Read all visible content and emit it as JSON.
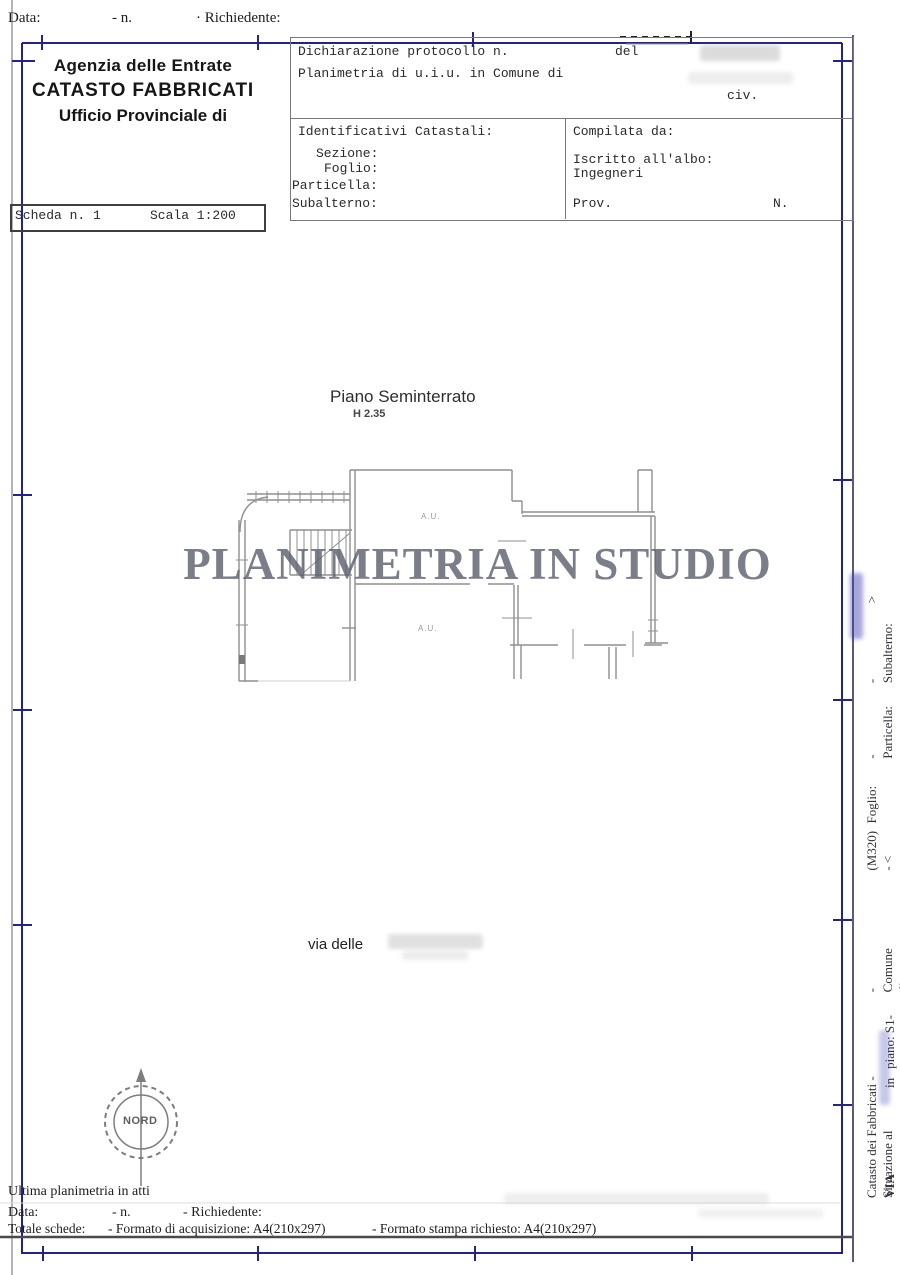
{
  "top_row": {
    "data_label": "Data:",
    "n_label": "- n.",
    "richiedente_label": "· Richiedente:"
  },
  "agency": {
    "line1": "Agenzia delle Entrate",
    "line2": "CATASTO FABBRICATI",
    "line3": "Ufficio Provinciale di"
  },
  "scheda": {
    "scheda_label": "Scheda n. 1",
    "scala_label": "Scala 1:200"
  },
  "protocol": {
    "dichiarazione_label": "Dichiarazione protocollo n.",
    "del_label": "del",
    "planimetria_label": "Planimetria di u.i.u. in Comune di",
    "civ_label": "civ."
  },
  "identificativi": {
    "title": "Identificativi Catastali:",
    "sezione_label": "Sezione:",
    "foglio_label": "Foglio:",
    "particella_label": "Particella:",
    "subalterno_label": "Subalterno:"
  },
  "compilata": {
    "title": "Compilata da:",
    "iscritto_label": "Iscritto all'albo:",
    "albo_value": "Ingegneri",
    "prov_label": "Prov.",
    "n_label": "N."
  },
  "drawing": {
    "floor_title": "Piano Seminterrato",
    "height_label": "H 2.35",
    "room_label_top": "A.U.",
    "room_label_bottom": "A.U.",
    "street_label": "via delle",
    "watermark": "PLANIMETRIA IN STUDIO",
    "compass_label": "NORD",
    "scale_note": "Scala 1:200"
  },
  "footer": {
    "ultima_label": "Ultima planimetria in atti",
    "data_label": "Data:",
    "n_label": "- n.",
    "richiedente_label": "- Richiedente:",
    "totale_label": "Totale schede:",
    "formato_acquisizione": "- Formato di acquisizione: A4(210x297)",
    "formato_stampa": "- Formato stampa richiesto: A4(210x297)"
  },
  "right_margin": {
    "outer": [
      "Catasto dei Fabbricati - Situazione al",
      "- Comune di",
      "(M320) - <",
      "Foglio:",
      "- Particella:",
      "- Subalterno:",
      ">"
    ],
    "inner": [
      "VIA",
      "in",
      "piano: S1-T-1-2;"
    ]
  },
  "colors": {
    "border_blue": "#23238e",
    "wall_gray": "#8f8f8f",
    "watermark_gray": "#5d6270",
    "scan_edge_gray": "#b3b3b3"
  }
}
